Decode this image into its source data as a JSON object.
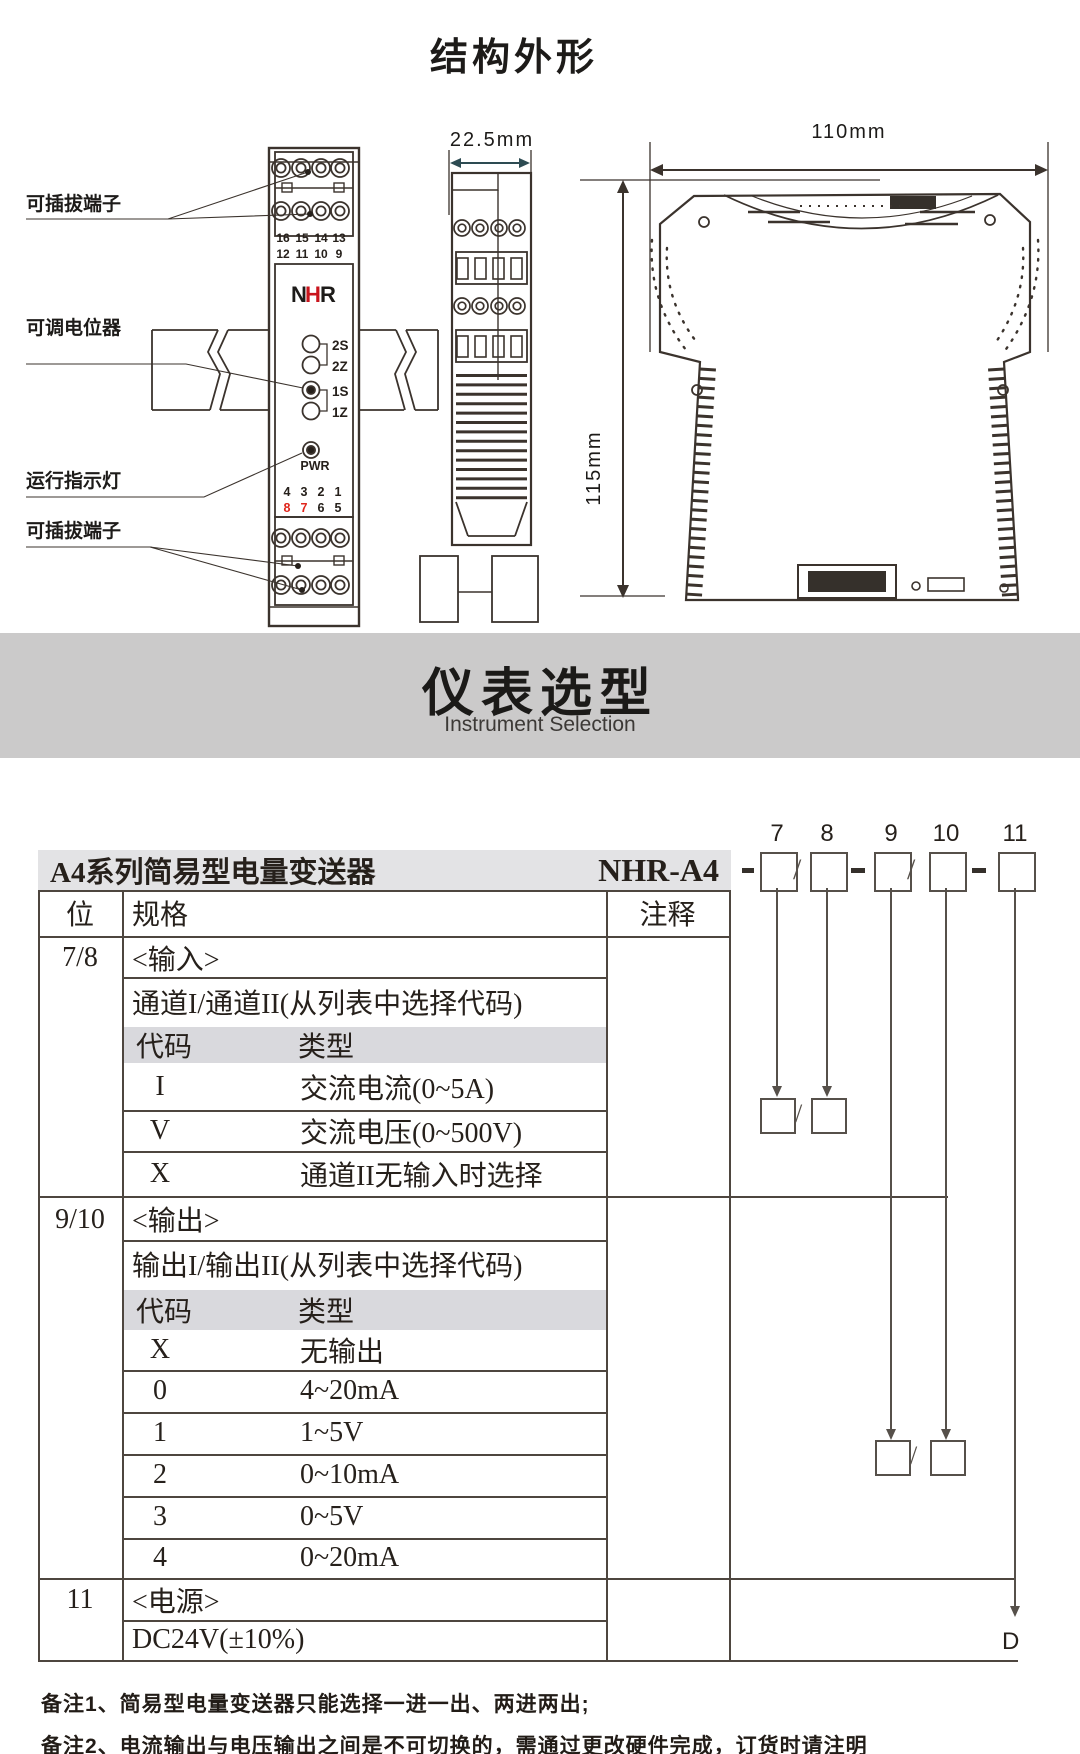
{
  "page_heading": "结构外形",
  "banner": {
    "title": "仪表选型",
    "subtitle": "Instrument Selection"
  },
  "drawing": {
    "callouts": {
      "plug_top": "可插拔端子",
      "potentiometer": "可调电位器",
      "run_indicator": "运行指示灯",
      "plug_bottom": "可插拔端子"
    },
    "dimensions": {
      "width": "22.5mm",
      "height": "115mm",
      "depth": "110mm"
    },
    "front": {
      "logo": {
        "n": "N",
        "h": "H",
        "r": "R"
      },
      "top_terminals_row1": [
        "16",
        "15",
        "14",
        "13"
      ],
      "top_terminals_row2": [
        "12",
        "11",
        "10",
        "9"
      ],
      "pot_labels": [
        "2S",
        "2Z",
        "1S",
        "1Z"
      ],
      "pwr_label": "PWR",
      "mid_terminals_row1": [
        "4",
        "3",
        "2",
        "1"
      ],
      "mid_terminals_row2": [
        "8",
        "7",
        "6",
        "5"
      ]
    },
    "colors": {
      "line": "#3b332d",
      "dim_accent": "#2d4b52",
      "red": "#e0251b"
    }
  },
  "selection": {
    "series_title": "A4系列简易型电量变送器",
    "model_prefix": "NHR-A4",
    "position_numbers": [
      "7",
      "8",
      "9",
      "10",
      "11"
    ],
    "slash": "/",
    "d_suffix": "D",
    "columns": {
      "pos": "位",
      "spec": "规格",
      "note": "注释"
    },
    "sections": [
      {
        "pos": "7/8",
        "title": "<输入>",
        "desc": "通道I/通道II(从列表中选择代码)",
        "code_label": "代码",
        "type_label": "类型",
        "rows": [
          {
            "code": "I",
            "type": "交流电流(0~5A)"
          },
          {
            "code": "V",
            "type": "交流电压(0~500V)"
          },
          {
            "code": "X",
            "type": "通道II无输入时选择"
          }
        ]
      },
      {
        "pos": "9/10",
        "title": "<输出>",
        "desc": "输出I/输出II(从列表中选择代码)",
        "code_label": "代码",
        "type_label": "类型",
        "rows": [
          {
            "code": "X",
            "type": "无输出"
          },
          {
            "code": "0",
            "type": "4~20mA"
          },
          {
            "code": "1",
            "type": "1~5V"
          },
          {
            "code": "2",
            "type": "0~10mA"
          },
          {
            "code": "3",
            "type": "0~5V"
          },
          {
            "code": "4",
            "type": "0~20mA"
          }
        ]
      },
      {
        "pos": "11",
        "title": "<电源>",
        "desc": "DC24V(±10%)"
      }
    ],
    "notes": [
      "备注1、简易型电量变送器只能选择一进一出、两进两出;",
      "备注2、电流输出与电压输出之间是不可切换的，需通过更改硬件完成，订货时请注明"
    ]
  }
}
